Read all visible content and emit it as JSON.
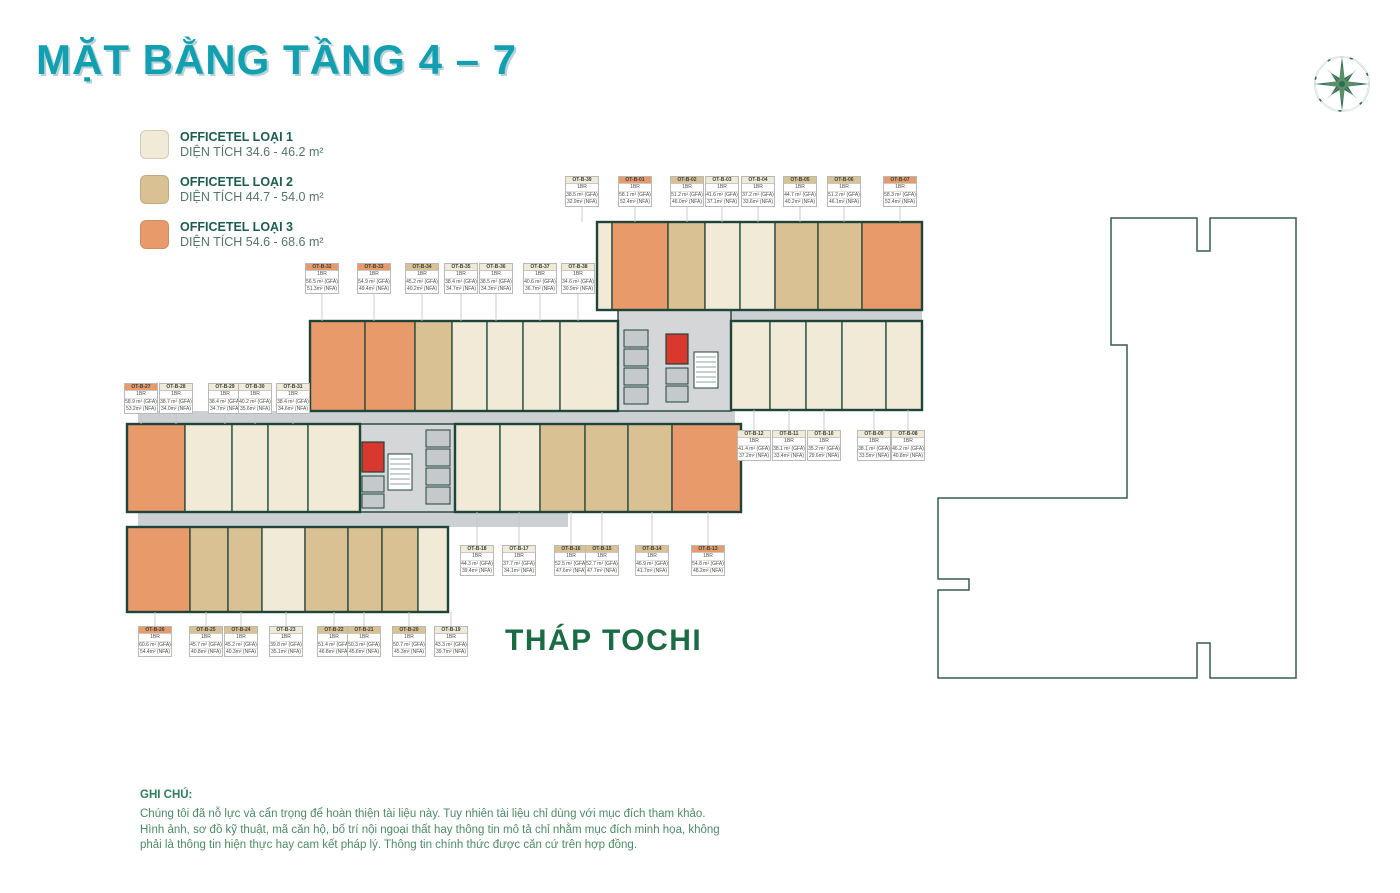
{
  "page": {
    "title": "MẶT BẰNG TẦNG 4 – 7",
    "tower_label": "THÁP TOCHI"
  },
  "legend": {
    "items": [
      {
        "name": "OFFICETEL LOẠI 1",
        "area": "DIỆN TÍCH 34.6 - 46.2 m²",
        "type": "type1"
      },
      {
        "name": "OFFICETEL LOẠI 2",
        "area": "DIỆN TÍCH 44.7 - 54.0 m²",
        "type": "type2"
      },
      {
        "name": "OFFICETEL LOẠI 3",
        "area": "DIỆN TÍCH 54.6 - 68.6 m²",
        "type": "type3"
      }
    ]
  },
  "colors": {
    "type1": "#f0ead7",
    "type2": "#d9c193",
    "type3": "#e89a6b",
    "wall": "#1f4438",
    "corridor": "#cdd0d3",
    "core_bg": "#d4d6d7",
    "core_cell": "#c6c9cb",
    "stair_red": "#d9382f",
    "outline_green": "#355d4e",
    "title_teal": "#129fb0",
    "tower_green": "#1b6b45",
    "logo_green": "#2e6b4f"
  },
  "note": {
    "heading": "GHI CHÚ:",
    "lines": [
      "Chúng tôi đã nỗ lực và cẩn trọng để hoàn thiện tài liệu này. Tuy nhiên tài liệu chỉ dùng với mục đích tham khảo.",
      "Hình ảnh, sơ đồ kỹ thuật, mã căn hộ, bố trí nội ngoại thất hay thông tin mô tả chỉ nhằm mục đích minh họa, không",
      "phải là thông tin hiện thực hay cam kết pháp lý. Thông tin chính thức được căn cứ trên hợp đồng."
    ]
  },
  "units": [
    {
      "id": "OT-B-01",
      "bedrooms": "1BR",
      "gfa": "58.1 m² (GFA)",
      "nfa": "52.4m² (NFA)",
      "type": "type3"
    },
    {
      "id": "OT-B-02",
      "bedrooms": "1BR",
      "gfa": "51.2 m² (GFA)",
      "nfa": "46.0m² (NFA)",
      "type": "type2"
    },
    {
      "id": "OT-B-03",
      "bedrooms": "1BR",
      "gfa": "41.6 m² (GFA)",
      "nfa": "37.1m² (NFA)",
      "type": "type1"
    },
    {
      "id": "OT-B-04",
      "bedrooms": "1BR",
      "gfa": "37.2 m² (GFA)",
      "nfa": "33.6m² (NFA)",
      "type": "type1"
    },
    {
      "id": "OT-B-05",
      "bedrooms": "1BR",
      "gfa": "44.7 m² (GFA)",
      "nfa": "40.2m² (NFA)",
      "type": "type2"
    },
    {
      "id": "OT-B-06",
      "bedrooms": "1BR",
      "gfa": "51.2 m² (GFA)",
      "nfa": "46.1m² (NFA)",
      "type": "type2"
    },
    {
      "id": "OT-B-07",
      "bedrooms": "1BR",
      "gfa": "58.3 m² (GFA)",
      "nfa": "52.4m² (NFA)",
      "type": "type3"
    },
    {
      "id": "OT-B-08",
      "bedrooms": "1BR",
      "gfa": "46.2 m² (GFA)",
      "nfa": "40.8m² (NFA)",
      "type": "type1"
    },
    {
      "id": "OT-B-09",
      "bedrooms": "1BR",
      "gfa": "38.1 m² (GFA)",
      "nfa": "33.5m² (NFA)",
      "type": "type1"
    },
    {
      "id": "OT-B-10",
      "bedrooms": "1BR",
      "gfa": "35.2 m² (GFA)",
      "nfa": "29.6m² (NFA)",
      "type": "type1"
    },
    {
      "id": "OT-B-11",
      "bedrooms": "1BR",
      "gfa": "38.1 m² (GFA)",
      "nfa": "33.4m² (NFA)",
      "type": "type1"
    },
    {
      "id": "OT-B-12",
      "bedrooms": "1BR",
      "gfa": "41.4 m² (GFA)",
      "nfa": "37.2m² (NFA)",
      "type": "type1"
    },
    {
      "id": "OT-B-13",
      "bedrooms": "1BR",
      "gfa": "54.8 m² (GFA)",
      "nfa": "48.2m² (NFA)",
      "type": "type3"
    },
    {
      "id": "OT-B-14",
      "bedrooms": "1BR",
      "gfa": "46.9 m² (GFA)",
      "nfa": "41.7m² (NFA)",
      "type": "type2"
    },
    {
      "id": "OT-B-15",
      "bedrooms": "1BR",
      "gfa": "52.7 m² (GFA)",
      "nfa": "47.7m² (NFA)",
      "type": "type2"
    },
    {
      "id": "OT-B-16",
      "bedrooms": "1BR",
      "gfa": "52.5 m² (GFA)",
      "nfa": "47.6m² (NFA)",
      "type": "type2"
    },
    {
      "id": "OT-B-17",
      "bedrooms": "1BR",
      "gfa": "37.7 m² (GFA)",
      "nfa": "34.1m² (NFA)",
      "type": "type1"
    },
    {
      "id": "OT-B-18",
      "bedrooms": "1BR",
      "gfa": "44.3 m² (GFA)",
      "nfa": "39.4m² (NFA)",
      "type": "type1"
    },
    {
      "id": "OT-B-19",
      "bedrooms": "1BR",
      "gfa": "43.3 m² (GFA)",
      "nfa": "39.7m² (NFA)",
      "type": "type1"
    },
    {
      "id": "OT-B-20",
      "bedrooms": "1BR",
      "gfa": "50.7 m² (GFA)",
      "nfa": "45.3m² (NFA)",
      "type": "type2"
    },
    {
      "id": "OT-B-21",
      "bedrooms": "1BR",
      "gfa": "50.3 m² (GFA)",
      "nfa": "45.6m² (NFA)",
      "type": "type2"
    },
    {
      "id": "OT-B-22",
      "bedrooms": "1BR",
      "gfa": "51.4 m² (GFA)",
      "nfa": "46.8m² (NFA)",
      "type": "type2"
    },
    {
      "id": "OT-B-23",
      "bedrooms": "1BR",
      "gfa": "39.8 m² (GFA)",
      "nfa": "35.1m² (NFA)",
      "type": "type1"
    },
    {
      "id": "OT-B-24",
      "bedrooms": "1BR",
      "gfa": "45.2 m² (GFA)",
      "nfa": "40.3m² (NFA)",
      "type": "type2"
    },
    {
      "id": "OT-B-25",
      "bedrooms": "1BR",
      "gfa": "45.7 m² (GFA)",
      "nfa": "40.8m² (NFA)",
      "type": "type2"
    },
    {
      "id": "OT-B-26",
      "bedrooms": "1BR",
      "gfa": "60.6 m² (GFA)",
      "nfa": "54.4m² (NFA)",
      "type": "type3"
    },
    {
      "id": "OT-B-27",
      "bedrooms": "1BR",
      "gfa": "58.9 m² (GFA)",
      "nfa": "53.2m² (NFA)",
      "type": "type3"
    },
    {
      "id": "OT-B-28",
      "bedrooms": "1BR",
      "gfa": "38.7 m² (GFA)",
      "nfa": "34.0m² (NFA)",
      "type": "type1"
    },
    {
      "id": "OT-B-29",
      "bedrooms": "1BR",
      "gfa": "38.4 m² (GFA)",
      "nfa": "34.7m² (NFA)",
      "type": "type1"
    },
    {
      "id": "OT-B-30",
      "bedrooms": "1BR",
      "gfa": "40.2 m² (GFA)",
      "nfa": "35.6m² (NFA)",
      "type": "type1"
    },
    {
      "id": "OT-B-31",
      "bedrooms": "1BR",
      "gfa": "38.4 m² (GFA)",
      "nfa": "34.6m² (NFA)",
      "type": "type1"
    },
    {
      "id": "OT-B-32",
      "bedrooms": "1BR",
      "gfa": "56.5 m² (GFA)",
      "nfa": "51.3m² (NFA)",
      "type": "type3"
    },
    {
      "id": "OT-B-33",
      "bedrooms": "1BR",
      "gfa": "54.9 m² (GFA)",
      "nfa": "49.4m² (NFA)",
      "type": "type3"
    },
    {
      "id": "OT-B-34",
      "bedrooms": "1BR",
      "gfa": "45.2 m² (GFA)",
      "nfa": "40.2m² (NFA)",
      "type": "type2"
    },
    {
      "id": "OT-B-35",
      "bedrooms": "1BR",
      "gfa": "38.4 m² (GFA)",
      "nfa": "34.7m² (NFA)",
      "type": "type1"
    },
    {
      "id": "OT-B-36",
      "bedrooms": "1BR",
      "gfa": "38.5 m² (GFA)",
      "nfa": "34.3m² (NFA)",
      "type": "type1"
    },
    {
      "id": "OT-B-37",
      "bedrooms": "1BR",
      "gfa": "40.6 m² (GFA)",
      "nfa": "36.7m² (NFA)",
      "type": "type1"
    },
    {
      "id": "OT-B-38",
      "bedrooms": "1BR",
      "gfa": "34.6 m² (GFA)",
      "nfa": "30.9m² (NFA)",
      "type": "type1"
    },
    {
      "id": "OT-B-39",
      "bedrooms": "1BR",
      "gfa": "38.5 m² (GFA)",
      "nfa": "32.9m² (NFA)",
      "type": "type1"
    }
  ]
}
